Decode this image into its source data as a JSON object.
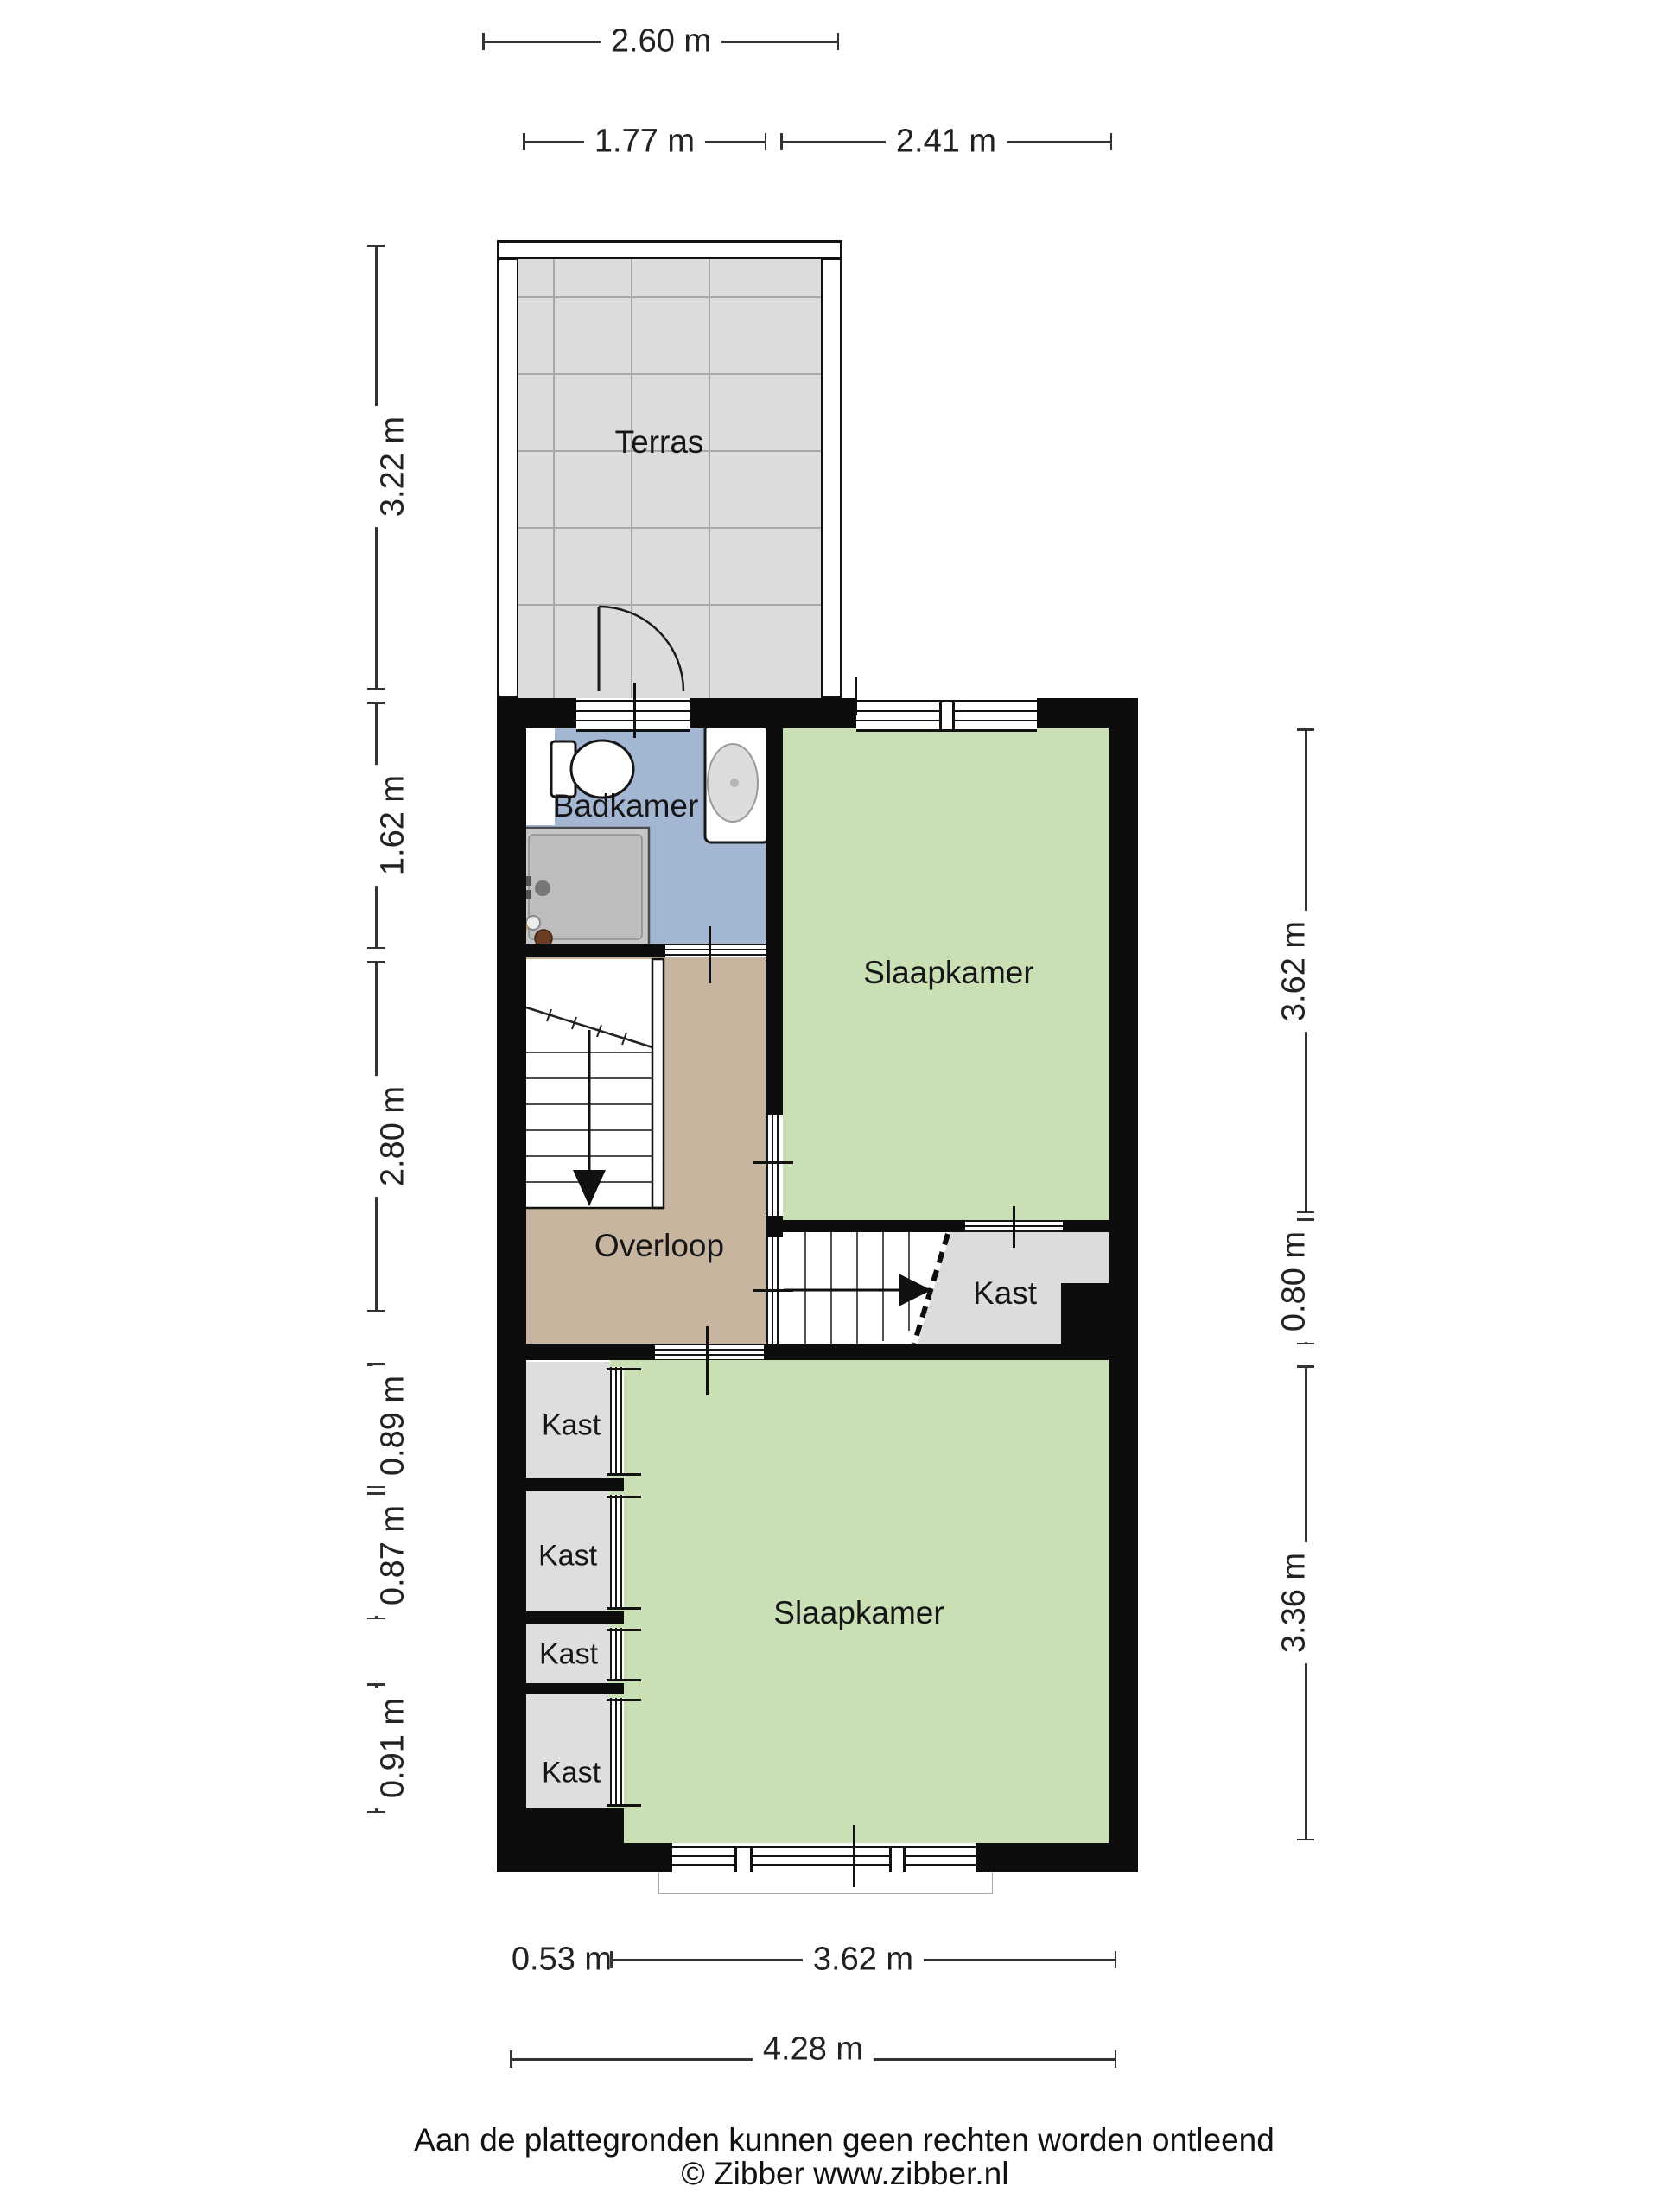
{
  "colors": {
    "wall": "#0d0d0d",
    "green": "#c9dfb4",
    "blue": "#a3b6d2",
    "tan": "#c8b5a0",
    "kast_gray": "#dedede",
    "tile": "#dcdcdc",
    "tile_line": "#a8a8a8",
    "text": "#1f1f1f"
  },
  "rooms": {
    "terras": "Terras",
    "badkamer": "Badkamer",
    "slaapkamer_boven": "Slaapkamer",
    "overloop": "Overloop",
    "kast_rechts": "Kast",
    "kast_1": "Kast",
    "kast_2": "Kast",
    "kast_3": "Kast",
    "kast_4": "Kast",
    "slaapkamer_beneden": "Slaapkamer"
  },
  "dimensions": {
    "top_total": "2.60 m",
    "top_left": "1.77 m",
    "top_right": "2.41 m",
    "left_terras": "3.22 m",
    "left_badkamer": "1.62 m",
    "left_overloop": "2.80 m",
    "left_kast1": "0.89 m",
    "left_kast2": "0.87 m",
    "left_kast4": "0.91 m",
    "right_slaapkamer_boven": "3.62 m",
    "right_kast": "0.80 m",
    "right_slaapkamer_beneden": "3.36 m",
    "bottom_kast": "0.53 m",
    "bottom_slaapkamer": "3.62 m",
    "bottom_total": "4.28 m"
  },
  "footer": {
    "disclaimer": "Aan de plattegronden kunnen geen rechten worden ontleend",
    "copyright": "© Zibber www.zibber.nl"
  }
}
